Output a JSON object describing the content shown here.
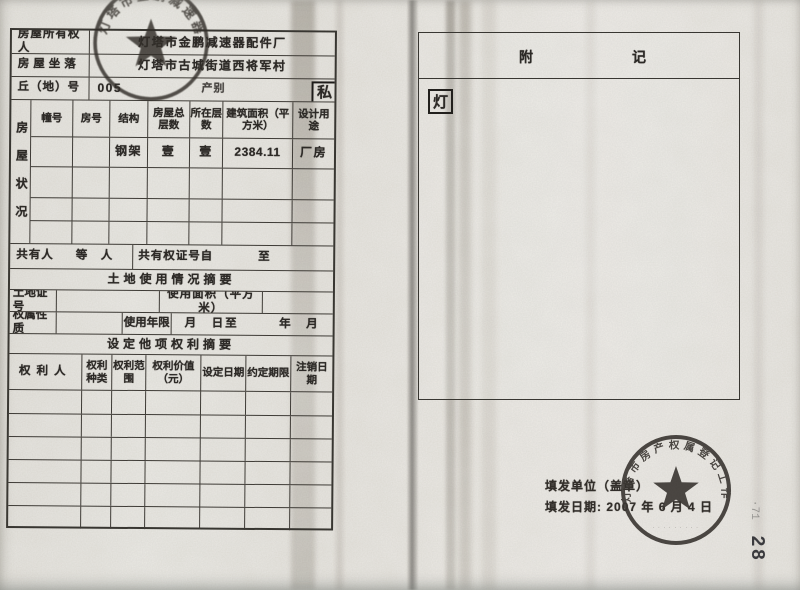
{
  "left_page": {
    "owner": {
      "label": "房屋所有权人",
      "value": "灯塔市金鹏减速器配件厂"
    },
    "location": {
      "label": "房屋坐落",
      "value": "灯塔市古城街道西将军村"
    },
    "plot": {
      "label": "丘（地）号",
      "value": "005",
      "category_label": "产别",
      "category_value": "私"
    },
    "status": {
      "side_label": "房屋状况",
      "columns": [
        "幢号",
        "房号",
        "结构",
        "房屋总层数",
        "所在层数",
        "建筑面积（平方米）",
        "设计用途"
      ],
      "row": [
        "",
        "",
        "钢架",
        "壹",
        "壹",
        "2384.11",
        "厂房"
      ]
    },
    "co_owner": {
      "label": "共有人",
      "suffix": "等　人",
      "cert_no_label": "共有权证号自",
      "to_label": "至"
    },
    "land_title": "土地使用情况摘要",
    "land": {
      "cert_label": "土地证号",
      "area_label": "使用面积（平方米）"
    },
    "tenure": {
      "label": "权属性质",
      "years_label": "使用年限",
      "period_label": "年　月　日至　　　年　月　日"
    },
    "rights_title": "设定他项权利摘要",
    "rights": {
      "columns": [
        "权利人",
        "权利种类",
        "权利范围",
        "权利价值（元）",
        "设定日期",
        "约定期限",
        "注销日期"
      ]
    }
  },
  "right_page": {
    "appendix_title_left": "附",
    "appendix_title_right": "记",
    "note_char": "灯",
    "issuer_label": "填发单位（盖章）",
    "issue_date_label": "填发日期:",
    "issue_date": "2007 年 6 月 4 日"
  },
  "stamps": {
    "owner_seal_text": "灯塔市金鹏减速器配件厂",
    "registry_seal_text": "灯塔市房产权属登记工作办公室"
  },
  "margin": {
    "faint_mark": "·71",
    "page_number": "28"
  }
}
